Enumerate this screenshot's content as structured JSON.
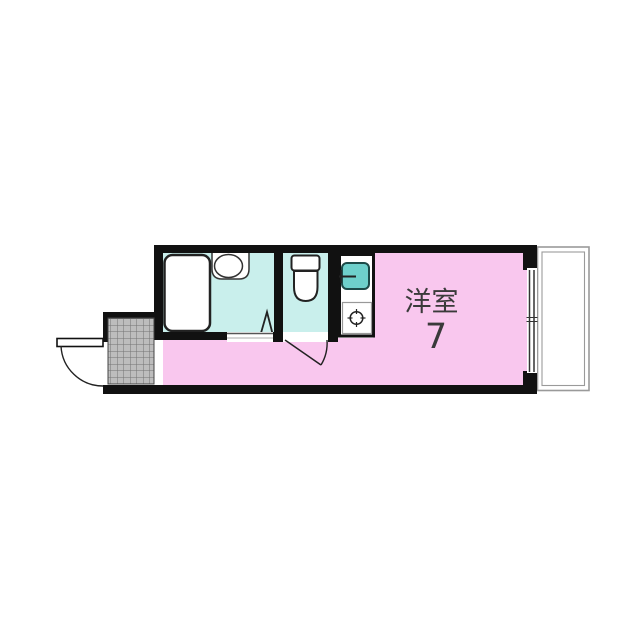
{
  "floor_plan": {
    "labels": {
      "room_name": "洋室",
      "room_size": "7"
    },
    "colors": {
      "room_fill": "#f9c7ee",
      "wet_area_fill": "#c9efec",
      "sink_fill": "#6ed0cb",
      "wall": "#111111",
      "tile": "#bdbdbd",
      "tile_line": "#747474",
      "balcony_border": "#9a9a9a",
      "fixture_outline": "#222222",
      "label_text": "#3a3a3a"
    },
    "elements": [
      "bathtub",
      "wash-basin",
      "folding-door",
      "toilet",
      "kitchen-counter",
      "kitchen-sink",
      "faucet",
      "stove-burner",
      "washroom-threshold",
      "toilet-door",
      "entrance-tile",
      "entry-door",
      "window",
      "balcony"
    ]
  }
}
